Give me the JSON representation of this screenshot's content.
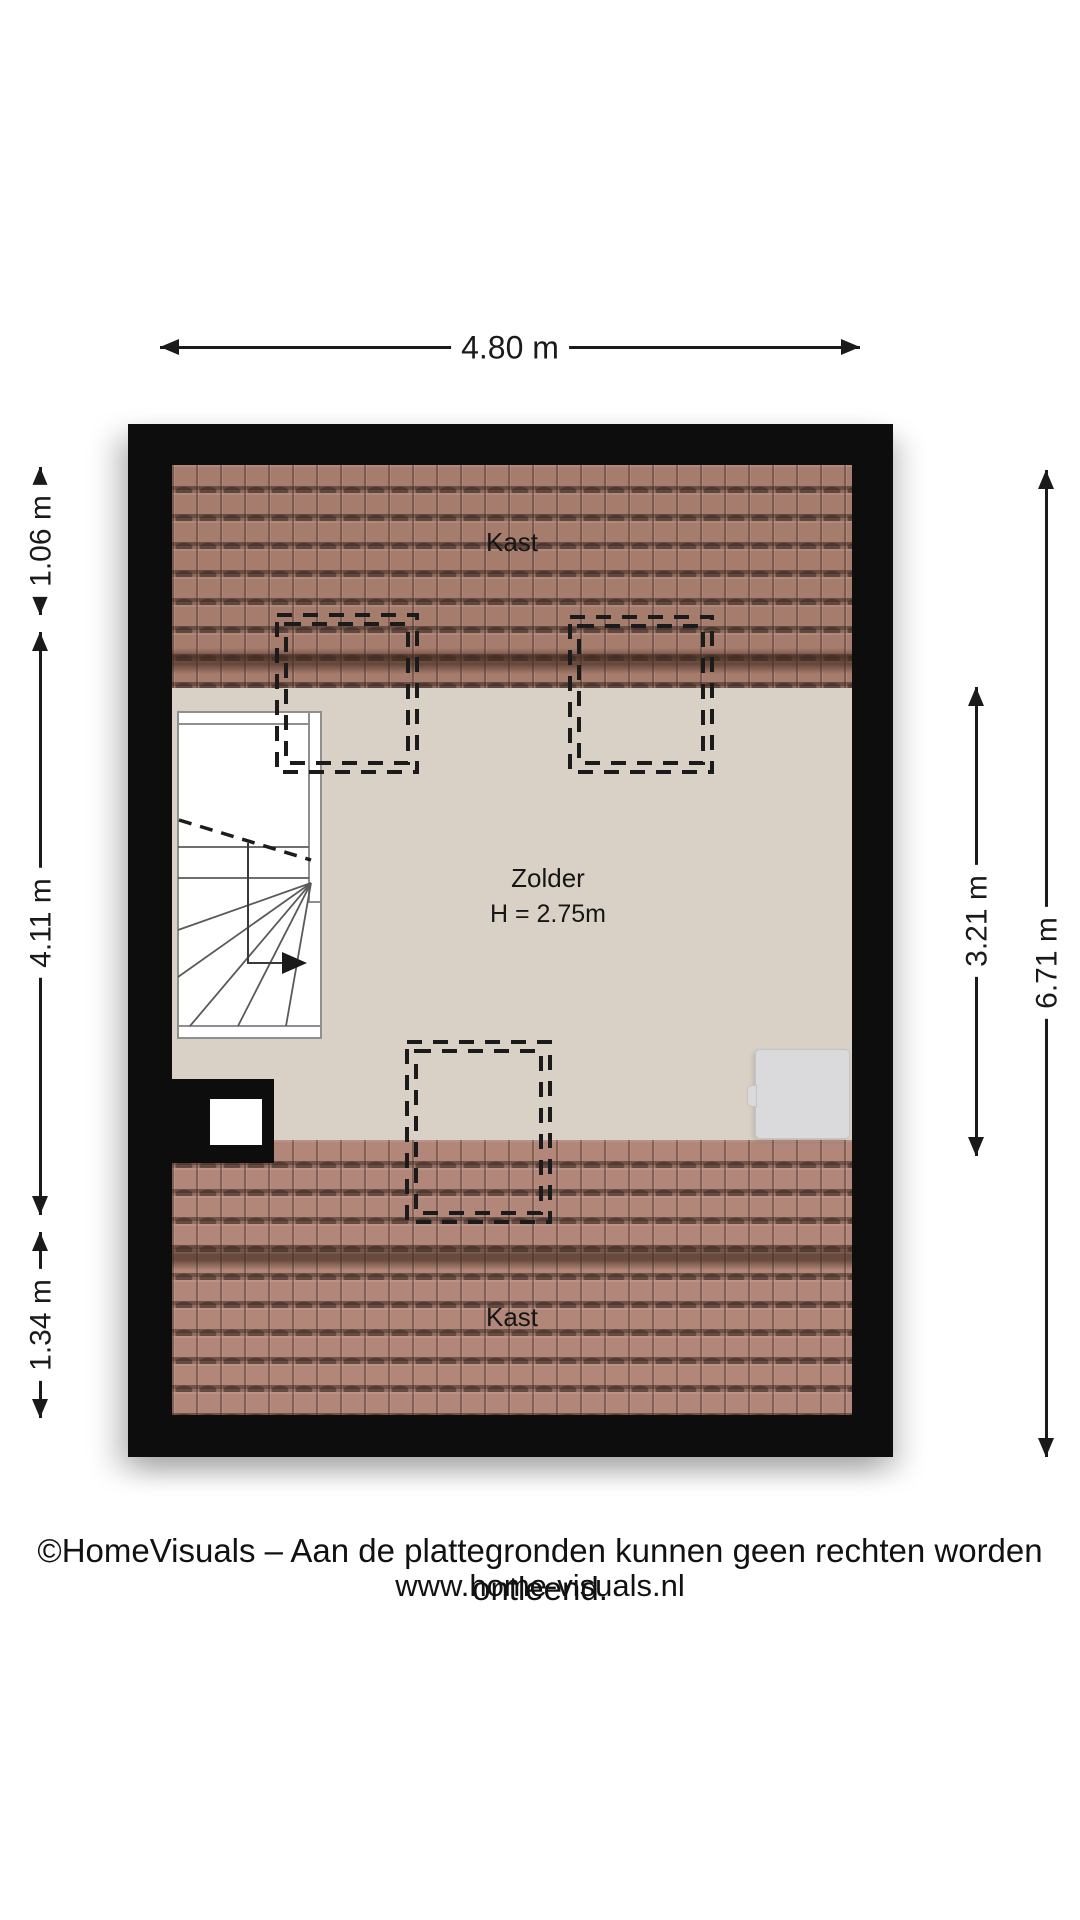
{
  "plan": {
    "dimensions_top": {
      "label": "4.80 m"
    },
    "dimensions_left": [
      {
        "label": "1.06 m"
      },
      {
        "label": "4.11 m"
      },
      {
        "label": "1.34 m"
      }
    ],
    "dimensions_right": [
      {
        "label": "3.21 m"
      },
      {
        "label": "6.71 m"
      }
    ],
    "rooms": {
      "kast_top": "Kast",
      "zolder_name": "Zolder",
      "zolder_height": "H = 2.75m",
      "kast_bottom": "Kast"
    }
  },
  "footer": {
    "line1": "©HomeVisuals – Aan de plattegronden kunnen geen rechten worden ontleend.",
    "line2": "www.home-visuals.nl"
  },
  "colors": {
    "wall": "#0d0d0d",
    "floor": "#d9d1c6",
    "roof_top": "#a67c6d",
    "roof_bottom": "#b28678",
    "roof_shade_band": "#3d261c",
    "furniture": "#dadadc",
    "dash_outline": "#1b1b1b",
    "dimension": "#1a1a1a"
  },
  "icons": {
    "dimension_arrowheads": "css-triangles-up-down-left-right",
    "stair_direction_arrow": "filled-right-triangle"
  }
}
